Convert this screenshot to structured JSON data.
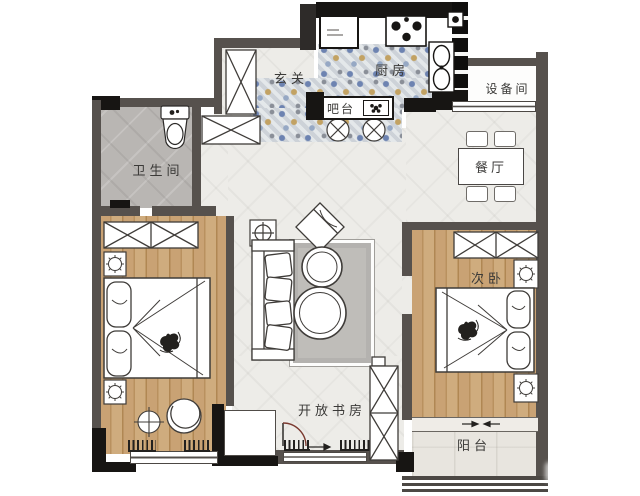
{
  "rooms": {
    "entry": {
      "label": "玄关"
    },
    "kitchen": {
      "label": "厨房"
    },
    "bar_counter": {
      "label": "吧台"
    },
    "equipment_room": {
      "label": "设备间"
    },
    "dining_room": {
      "label": "餐厅"
    },
    "bathroom": {
      "label": "卫生间"
    },
    "second_bedroom": {
      "label": "次卧"
    },
    "open_study": {
      "label": "开放书房"
    },
    "balcony": {
      "label": "阳台"
    }
  },
  "colors": {
    "wall": "#56514d",
    "wall_black": "#171513",
    "wood_floor": "#c39a6b",
    "tile_floor": "#edece8",
    "bathroom_floor": "#b9b6b3",
    "rug": "#b4b2af",
    "door_arc": "#7b3a30"
  }
}
